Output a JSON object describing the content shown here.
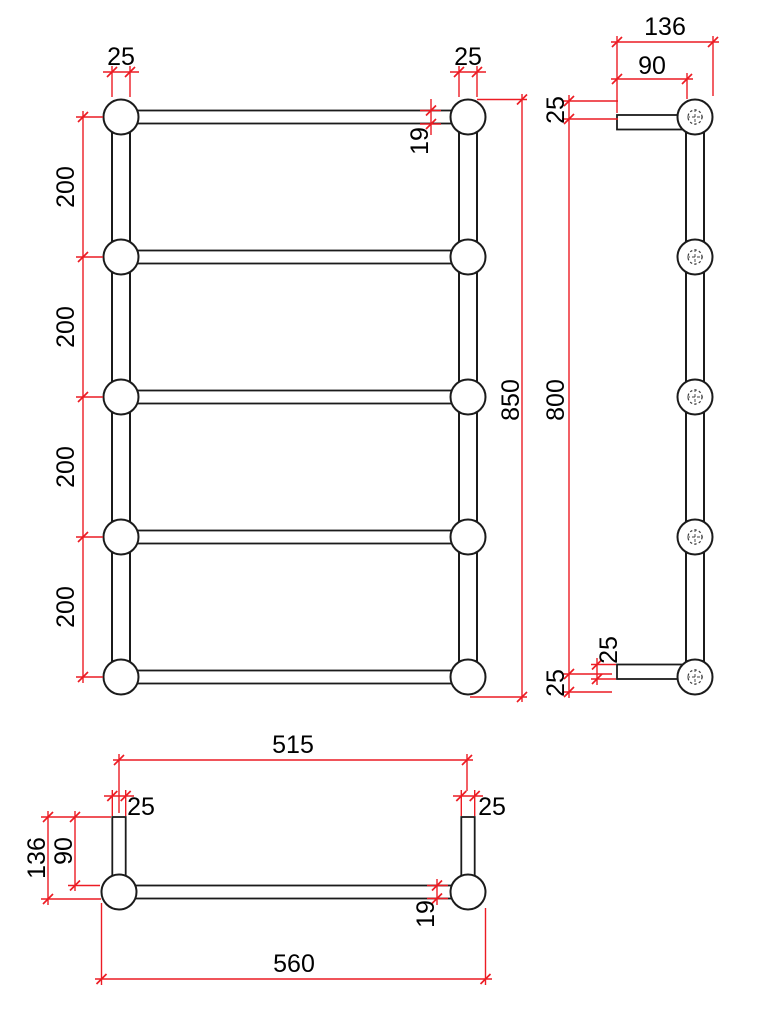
{
  "dims": {
    "front": {
      "tube_width_left": "25",
      "tube_width_right": "25",
      "rail_diameter": "19",
      "rung_spacing_1": "200",
      "rung_spacing_2": "200",
      "rung_spacing_3": "200",
      "rung_spacing_4": "200",
      "overall_height": "850"
    },
    "side": {
      "overall_depth": "136",
      "wall_to_tube": "90",
      "top_offset": "25",
      "fixing_centres": "800",
      "bottom_bracket_height": "25",
      "bottom_offset": "25"
    },
    "plan": {
      "fixing_centres": "515",
      "bracket_width_left": "25",
      "bracket_width_right": "25",
      "wall_to_rail": "90",
      "overall_depth": "136",
      "rail_diameter": "19",
      "overall_width": "560"
    }
  }
}
